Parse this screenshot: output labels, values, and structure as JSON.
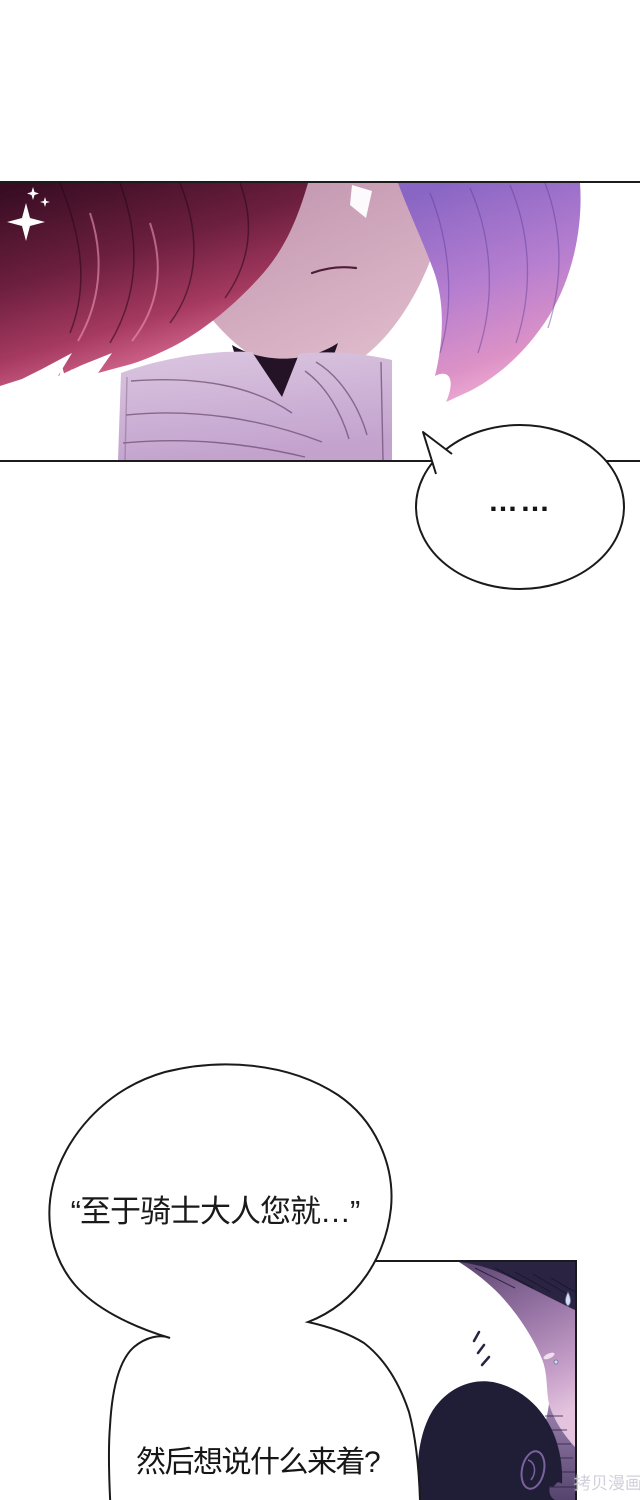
{
  "page": {
    "width": 640,
    "height": 1500,
    "background": "#ffffff"
  },
  "panel_top": {
    "border_color": "#1c1c1c",
    "colors": {
      "hair_left_dark": "#380d23",
      "hair_left_mid": "#6d1f3f",
      "hair_left_highlight": "#a63a60",
      "hair_left_tip": "#eb95b4",
      "hair_right_top": "#8a66c4",
      "hair_right_mid": "#b57ed0",
      "hair_right_bottom": "#f3b5da",
      "skin_dark": "#bc8fab",
      "skin_light": "#e0bccb",
      "mouth_line": "#4f1d38",
      "neck_shadow": "#241327",
      "collar_light": "#dbc6e0",
      "collar_dark": "#c3a3ce",
      "collar_fold_line": "#6f4f73",
      "sparkle": "#ffffff"
    }
  },
  "silence_bubble": {
    "text": "……",
    "outline": "#1a1a1a",
    "fill": "#ffffff"
  },
  "big_bubble": {
    "line1": "“至于骑士大人您就…”",
    "line2": "然后想说什么来着?",
    "outline": "#1a1a1a",
    "fill": "#ffffff",
    "text_color": "#1a1a1a"
  },
  "panel_bottom": {
    "border_color": "#1a1a1a",
    "colors": {
      "pillar_light": "#e9e4f5",
      "pillar_dark": "#cfc3e8",
      "pillar_strand": "#b9abd9",
      "knight_hair": "#2b2342",
      "knight_face_dark": "#5c4570",
      "knight_face_light": "#e3c3de",
      "head_silhouette": "#201d36",
      "ear_outline": "#7a639c",
      "shoulder_hatch_light": "#9d82ae",
      "shoulder_hatch_dark": "#55446e",
      "sweat_drop": "#d7def4"
    }
  },
  "watermark": {
    "text": "拷贝漫画",
    "color": "#cfccd8"
  }
}
